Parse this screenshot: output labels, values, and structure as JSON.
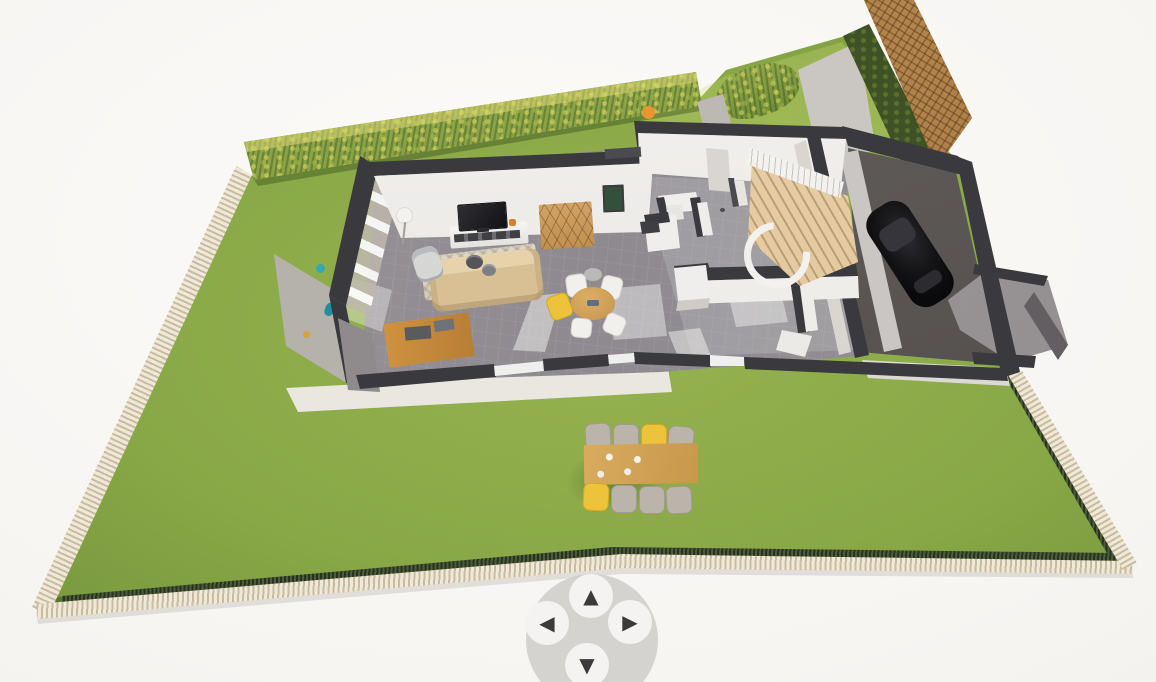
{
  "viewport": {
    "kind": "3d-home-planner-view",
    "description": "Isometric cutaway 3D floor plan of a single-storey house on a fenced lawn",
    "background_color": "#f7f5f2"
  },
  "nav_pad": {
    "base_color": "#cecccA",
    "button_color": "#f4f3f1",
    "arrow_color": "#3a3a3a",
    "buttons": [
      {
        "id": "pan-up",
        "icon": "triangle-up-icon",
        "glyph": "▲"
      },
      {
        "id": "pan-left",
        "icon": "triangle-left-icon",
        "glyph": "◀"
      },
      {
        "id": "pan-right",
        "icon": "triangle-right-icon",
        "glyph": "▶"
      },
      {
        "id": "pan-down",
        "icon": "triangle-down-icon",
        "glyph": "▼"
      }
    ]
  },
  "scene": {
    "lot": {
      "lawn_color": "#8aa946",
      "left_fence": "light wood slat fence",
      "bottom_fence": "light wood slat fence with dark picket fence inside",
      "right_fence": "light wood slat fence with dark picket fence inside",
      "top_boundary": "yellow-green hedge with gap for front path",
      "back_corner": "brown trellis panel with dark hedge strip",
      "front_path_color": "#bcb8b4"
    },
    "outdoor_dining_set": {
      "table_color": "#d0a258",
      "seats": 8,
      "chair_colors_top_row": [
        "gray",
        "gray",
        "yellow",
        "gray"
      ],
      "chair_colors_bottom_row": [
        "yellow",
        "gray",
        "gray",
        "gray"
      ]
    },
    "house": {
      "style": "cutaway walls with charcoal caps, white interior faces, gray tile floor",
      "wall_cap_color": "#3a393d",
      "floor_color": "#938f94",
      "terrace_color": "#eae7e1",
      "rooms": [
        "living-room",
        "dining-area",
        "wc-kitchen-block",
        "hallway",
        "garage"
      ],
      "living_room_items": [
        "tv",
        "tv-stand",
        "honeycomb-shelf",
        "wall-picture",
        "floor-lamp",
        "sofa",
        "armchair",
        "rug",
        "coffee-baskets",
        "desk"
      ],
      "dining_area": {
        "round_table_color": "#d2a35c",
        "chairs": [
          "white",
          "white",
          "white",
          "white",
          "yellow"
        ],
        "pendant_light_color": "#c3c1be"
      },
      "staircase": {
        "type": "curved wooden stair",
        "tread_color": "#e6cda6",
        "railing_color": "#f3f1ee"
      },
      "garage": {
        "floor_color": "#575250",
        "car_color": "#141416"
      },
      "annex_color": "#9b979a"
    }
  }
}
